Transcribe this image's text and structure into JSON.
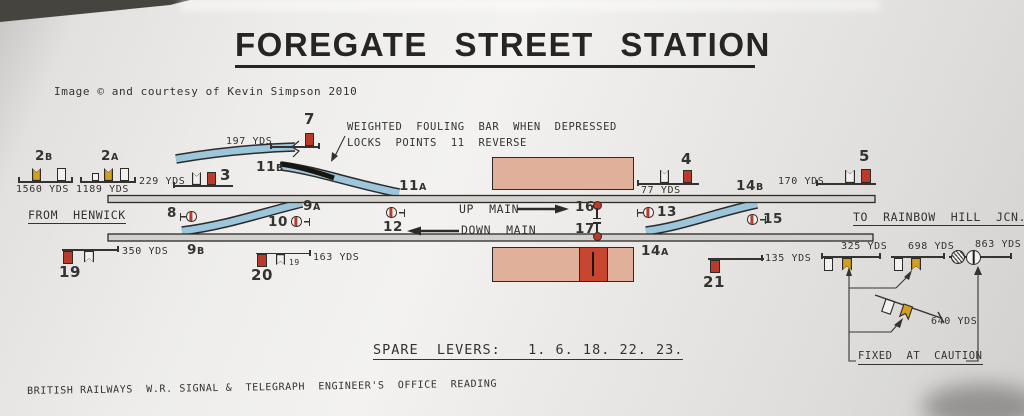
{
  "title": "FOREGATE STREET STATION",
  "credit": "Image © and courtesy of Kevin Simpson 2010",
  "footer": "BRITISH RAILWAYS  W.R. SIGNAL &  TELEGRAPH  ENGINEER'S  OFFICE  READING",
  "spare_levers": "SPARE  LEVERS:   1. 6. 18. 22. 23.",
  "notes": {
    "fouling1": "WEIGHTED  FOULING  BAR  WHEN  DEPRESSED",
    "fouling2": "LOCKS  POINTS  11  REVERSE",
    "fixed": "FIXED  AT  CAUTION"
  },
  "route": {
    "from": "FROM  HENWICK",
    "to": "TO  RAINBOW  HILL  JCN.",
    "up": "UP  MAIN",
    "down": "DOWN  MAIN"
  },
  "signals": {
    "s2b": {
      "num": "2",
      "suf": "B",
      "dist": "1560 YDS"
    },
    "s2a": {
      "num": "2",
      "suf": "A",
      "dist": "1189 YDS"
    },
    "s3": {
      "id": "3",
      "dist": "229 YDS"
    },
    "s7": {
      "id": "7",
      "dist": "197 YDS"
    },
    "s4": {
      "id": "4",
      "dist": "77 YDS"
    },
    "s5": {
      "id": "5",
      "dist": "170 YDS"
    },
    "s19": {
      "id": "19",
      "dist": "350 YDS"
    },
    "s20": {
      "id": "20",
      "dist": "163 YDS",
      "sub": "19"
    },
    "s21": {
      "id": "21",
      "dist": "135 YDS"
    },
    "s325": {
      "dist": "325 YDS"
    },
    "s698": {
      "dist": "698 YDS"
    },
    "s863": {
      "dist": "863 YDS"
    },
    "s640": {
      "dist": "640 YDS"
    }
  },
  "discs": {
    "d8": "8",
    "d10": "10",
    "d12": "12",
    "d13": "13",
    "d15": "15",
    "d16": "16",
    "d17": "17"
  },
  "points": {
    "p9a": {
      "num": "9",
      "suf": "A"
    },
    "p9b": {
      "num": "9",
      "suf": "B"
    },
    "p11a": {
      "num": "11",
      "suf": "A"
    },
    "p11b": {
      "num": "11",
      "suf": "B"
    },
    "p14a": {
      "num": "14",
      "suf": "A"
    },
    "p14b": {
      "num": "14",
      "suf": "B"
    }
  },
  "colors": {
    "signal_red": "#b93b2c",
    "signal_yellow": "#d2a01c",
    "track_blue": "#9cc6dc",
    "platform_pink": "#e0b09b",
    "ink": "#34332f"
  }
}
